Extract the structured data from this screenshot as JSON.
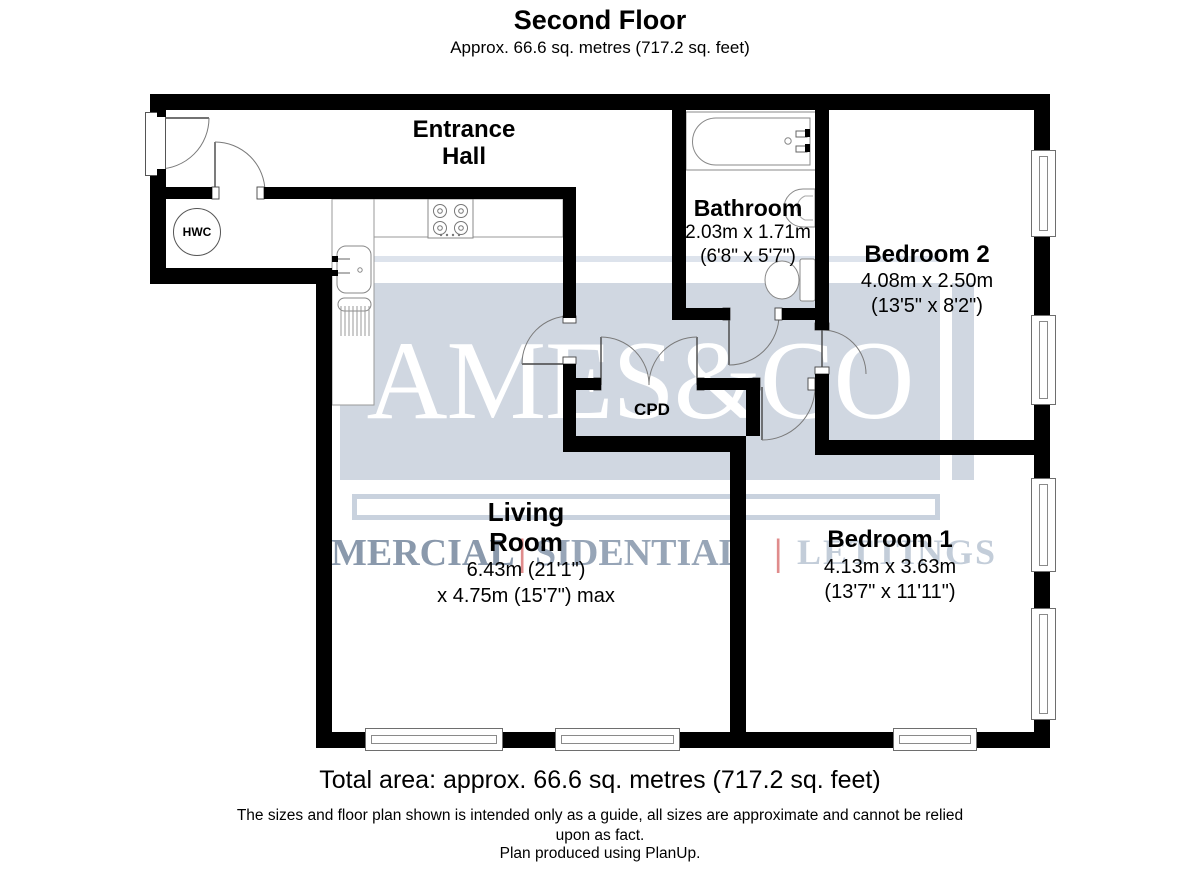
{
  "header": {
    "title": "Second Floor",
    "subtitle": "Approx. 66.6 sq. metres (717.2 sq. feet)"
  },
  "rooms": {
    "entrance_hall": {
      "line1": "Entrance",
      "line2": "Hall"
    },
    "bathroom": {
      "name": "Bathroom",
      "metric": "2.03m x 1.71m",
      "imperial": "(6'8\" x 5'7\")"
    },
    "bedroom2": {
      "name": "Bedroom 2",
      "metric": "4.08m x 2.50m",
      "imperial": "(13'5\" x 8'2\")"
    },
    "living_room": {
      "line1": "Living",
      "line2": "Room",
      "metric": "6.43m (21'1\")",
      "imperial_max": "x 4.75m (15'7\") max"
    },
    "bedroom1": {
      "name": "Bedroom 1",
      "metric": "4.13m x 3.63m",
      "imperial": "(13'7\" x 11'11\")"
    },
    "cpd": {
      "label": "CPD"
    },
    "hwc": {
      "label": "HWC"
    }
  },
  "watermark": {
    "brand": "AMES&CO",
    "left_word": "MERCIAL",
    "mid_word": "SIDENTIAL",
    "right_word": "LETTINGS",
    "separator": "|",
    "colors": {
      "panel": "#d0d7e1",
      "brand_text": "#ffffff",
      "word_dark": "#8a99ac",
      "word_mid": "#97a5b7",
      "word_light": "#c3cdd9",
      "separator": "#e08c8c"
    }
  },
  "footer": {
    "total_area": "Total area: approx. 66.6 sq. metres (717.2 sq. feet)",
    "disclaimer_line1": "The sizes and floor plan shown is intended only as a guide, all sizes are approximate and cannot be relied",
    "disclaimer_line2": "upon as fact.",
    "produced_by": "Plan produced using PlanUp."
  }
}
